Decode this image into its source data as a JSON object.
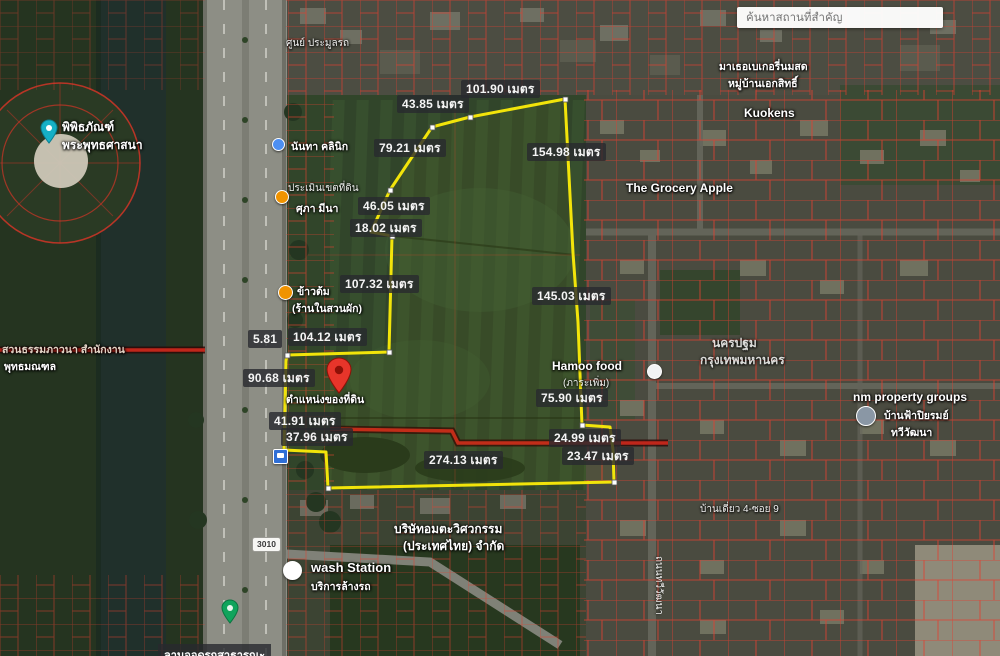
{
  "search": {
    "placeholder": "ค้นหาสถานที่สำคัญ"
  },
  "measurements": [
    "43.85 เมตร",
    "101.90 เมตร",
    "79.21 เมตร",
    "154.98 เมตร",
    "46.05 เมตร",
    "18.02 เมตร",
    "107.32 เมตร",
    "145.03 เมตร",
    "5.81",
    "104.12 เมตร",
    "90.68 เมตร",
    "75.90 เมตร",
    "41.91 เมตร",
    "37.96 เมตร",
    "24.99 เมตร",
    "23.47 เมตร",
    "274.13 เมตร"
  ],
  "pois": {
    "museum1": "พิพิธภัณฑ์",
    "museum2": "พระพุทธศาสนา",
    "dharma1": "สวนธรรมภาวนา สำนักงาน",
    "dharma2": "พุทธมณฑล",
    "auction": "ศูนย์ ประมูลรถ",
    "clinic": "นันทา คลินิก",
    "landeval1": "ประเมินเขตที่ดิน",
    "landeval2": "ศุภา มีนา",
    "porridge1": "ข้าวต้ม",
    "porridge2": "(ร้านในสวนผัก)",
    "pin_caption": "ตำแหน่งของที่ดิน",
    "hamoo1": "Hamoo food",
    "hamoo2": "(ภาระเพิ่ม)",
    "grocery": "The Grocery Apple",
    "kuokens": "Kuokens",
    "bakery1": "มาเธอเบเกอรี่นมสด",
    "bakery2": "หมู่บ้านเอกสิทธิ์",
    "province1": "นครปฐม",
    "province2": "กรุงเทพมหานคร",
    "nm1": "nm property groups",
    "nm2": "บ้านฟ้าปิยรมย์",
    "nm3": "ทวีวัฒนา",
    "wash1": "wash Station",
    "wash2": "บริการล้างรถ",
    "company1": "บริษัทอมตะวิศวกรรม",
    "company2": "(ประเทศไทย) จำกัด",
    "road_shield": "3010",
    "road_vertical": "ถนนทวีวัฒนา",
    "soi": "บ้านเดี่ยว 4-ซอย 9",
    "parking": "ลานจอดรถสาธารณะ"
  },
  "colors": {
    "parcel_red": "#e04030",
    "boundary_red": "#c0261b",
    "plot_yellow": "#f2e40a",
    "pin_red": "#e7352a",
    "museum_teal": "#16b0c6",
    "park_green": "#10a45c"
  }
}
